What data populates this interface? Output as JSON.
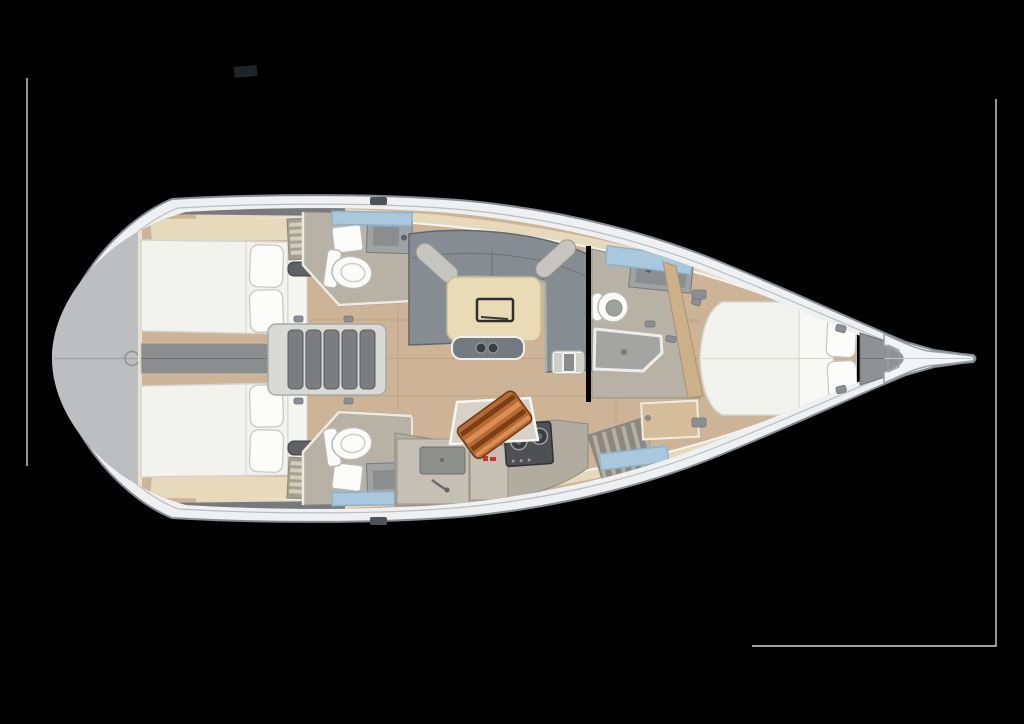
{
  "colors": {
    "background": "#000000",
    "frame_line": "#cdd6da",
    "mark_dark": "#202329",
    "hull_white": "#eef0f1",
    "hull_stroke": "#868c90",
    "wood_floor": "#cdb496",
    "wood_seam": "#b2977a",
    "deck_beige": "#e6d9bc",
    "coaming_gray": "#77797c",
    "transom_gray": "#bcbec0",
    "transom_seam": "#9fa1a3",
    "corridor_gray": "#8b8d8f",
    "stair_frame": "#d9d9d6",
    "stair_tread": "#7b7d80",
    "bed_white": "#f2f2ef",
    "bed_stroke": "#d5d5d0",
    "pillow_white": "#fcfcfa",
    "pillow_stroke": "#c5c5c0",
    "shelf_white": "#f5f5f2",
    "slat_bg": "#a59f93",
    "slat_bar": "#d6cdb8",
    "vent_dark": "#5f6164",
    "head_floor": "#b7b1a6",
    "head_stroke": "#948d81",
    "fixture_white": "#fbfbf9",
    "fixture_stroke": "#b9b9b4",
    "porcelain_inner": "#9fa1a1",
    "counter_gray": "#9fa3a3",
    "counter_inner": "#8a8e8e",
    "window_blue": "#a9c7dd",
    "window_stroke": "#8fb2cc",
    "sofa_gray": "#868d92",
    "sofa_stroke": "#60666b",
    "sofa_light": "#a9afb3",
    "bolster_gray": "#c7c5c0",
    "table_wood": "#eadbb7",
    "table_stroke": "#c9b890",
    "tray_dark": "#2f2f2f",
    "bench_gray": "#747b80",
    "cup_dark": "#3c3e40",
    "stool_white": "#f2f2ef",
    "stool_pad": "#cfcfca",
    "stool_mech": "#8a8d90",
    "galley_counter": "#b2aba0",
    "galley_stroke": "#8f887c",
    "cabinet_front": "#c6bfb4",
    "basin_gray": "#8e908c",
    "logo_red": "#cc3322",
    "stove_dark": "#4e5053",
    "stove_stroke": "#2f3133",
    "burner_ring": "#9a9c9e",
    "board_base": "#b96a33",
    "board_stripe": "#7a4015",
    "board_stripe2": "#d98f55",
    "shower_gray": "#a4a5a2",
    "shower_stroke": "#ececea",
    "partition_wood": "#cbb089",
    "partition_stroke": "#ab9272",
    "locker_gray": "#8f9193",
    "bow_white": "#f2f4f5",
    "bow_stroke": "#9aa0a4",
    "hardware_gray": "#8b8f93"
  },
  "scene": {
    "type": "yacht-interior-deck-plan",
    "objects": [
      "swim-platform",
      "companionway-stairs",
      "aft-cabin-port",
      "aft-cabin-starboard",
      "aft-head-port",
      "aft-head-starboard",
      "salon-sofa",
      "salon-table",
      "nav-stool",
      "galley",
      "stove",
      "sink",
      "cutting-board",
      "forward-head",
      "shower-pan",
      "forward-cabin",
      "v-berth",
      "anchor-locker",
      "bow-fitting"
    ],
    "berth_count": 3,
    "head_count": 3,
    "pillow_count": 6
  }
}
